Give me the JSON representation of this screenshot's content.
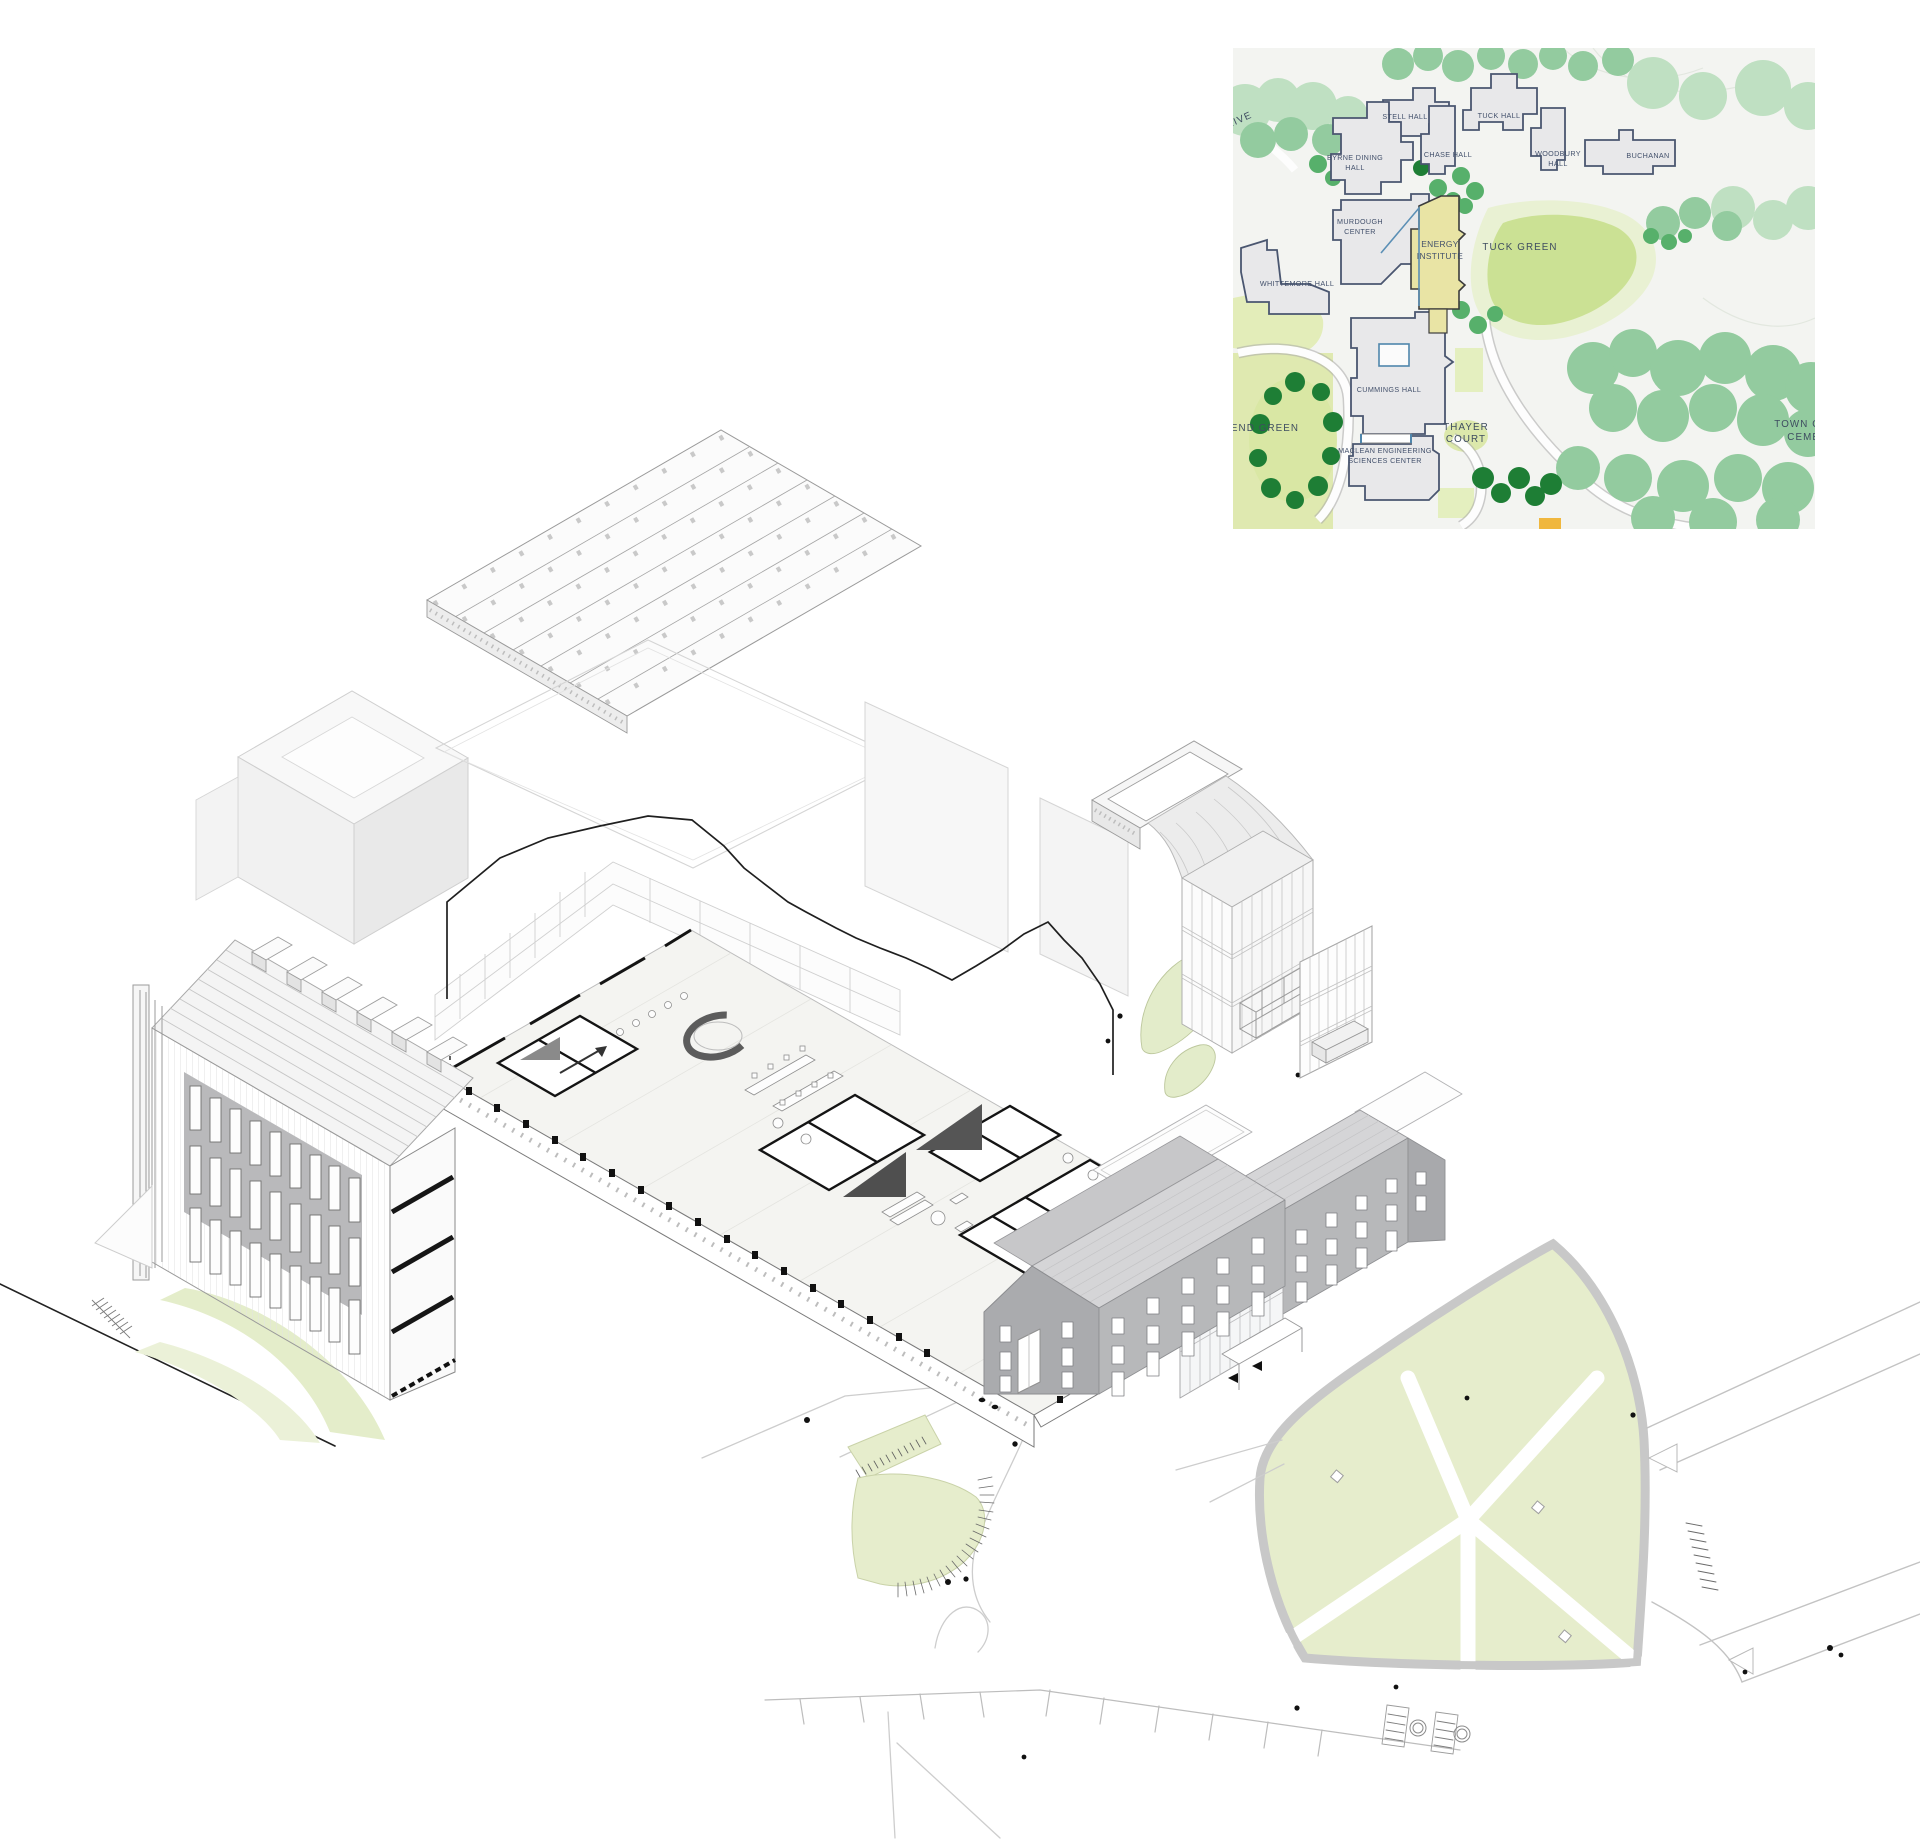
{
  "document": {
    "kind": "architectural exploded axonometric sheet with campus key map",
    "background": "#ffffff"
  },
  "map": {
    "name": "campus key map",
    "highlighted_building": "ENERGY INSTITUTE",
    "labels": {
      "drive": "RIVE",
      "stell": "STELL HALL",
      "tuck_hall": "TUCK HALL",
      "byrne1": "BYRNE DINING",
      "byrne2": "HALL",
      "chase": "CHASE HALL",
      "woodbury1": "WOODBURY",
      "woodbury2": "HALL",
      "buchanan": "BUCHANAN",
      "murdough1": "MURDOUGH",
      "murdough2": "CENTER",
      "energy1": "ENERGY",
      "energy2": "INSTITUTE",
      "tuck_green": "TUCK GREEN",
      "whittemore": "WHITTEMORE HALL",
      "cummings": "CUMMINGS HALL",
      "end_green": "END GREEN",
      "thayer1": "THAYER",
      "thayer2": "COURT",
      "maclean1": "MACLEAN ENGINEERING",
      "maclean2": "SCIENCES CENTER",
      "town1": "TOWN OF HA",
      "town2": "CEMETE"
    },
    "colors": {
      "paper": "#f3f4f1",
      "building": "#e8e8ea",
      "building_outline": "#4a5670",
      "highlight_yellow": "#e9e4a5",
      "label_text": "#42506b",
      "tree_pale": "#bfe0c2",
      "tree_mid": "#93cb9f",
      "tree_strong": "#57b06b",
      "tree_dark": "#1e7e35",
      "lawn": "#dce8ab",
      "accent_blue": "#5b8fb5"
    }
  },
  "drawing": {
    "components": [
      "sawtooth-skylight-roof",
      "ghost-massing",
      "section-cut-floor-plan",
      "louver-facade-building",
      "glass-stair-tower",
      "curtain-wall-panel",
      "gabled-dormitory-building",
      "site-plan-lawns-and-paths"
    ],
    "colors": {
      "ghost_line": "#d6d6d6",
      "mid_line": "#9a9a9a",
      "cut_line": "#1f1f1f",
      "site_green": "#e6edcc",
      "gray_wall": "#b3b4b6",
      "gray_roof": "#d6d6d8"
    }
  }
}
